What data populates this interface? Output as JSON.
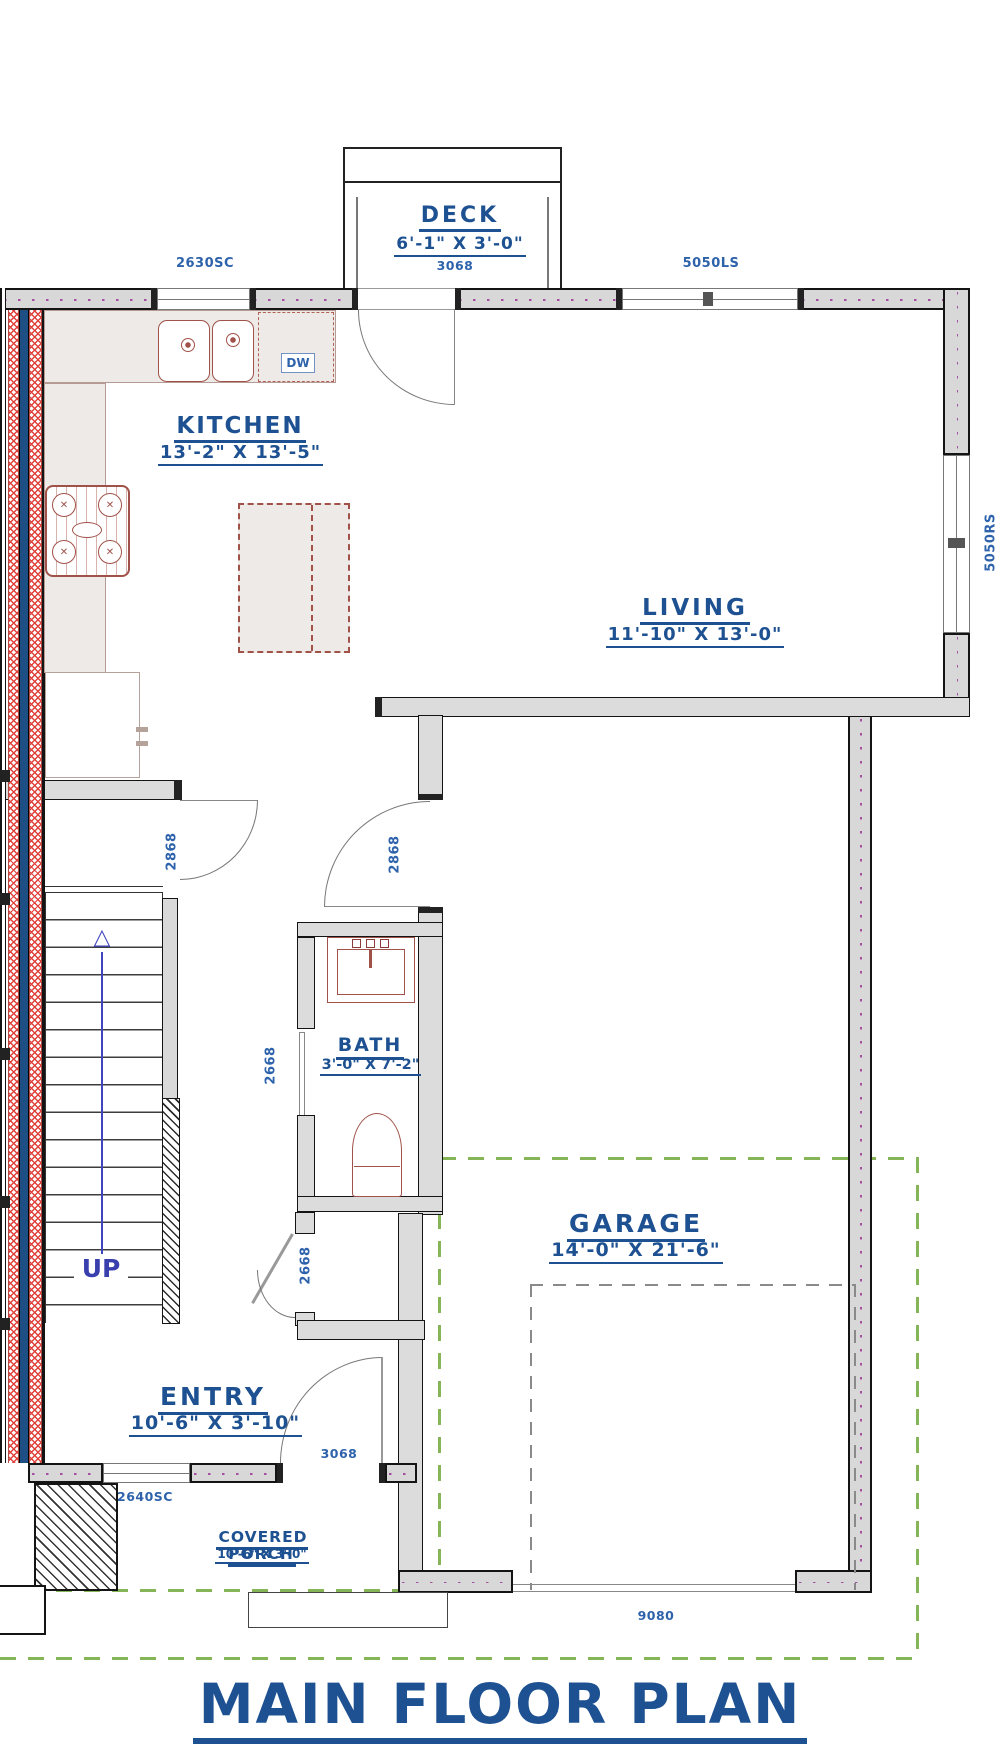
{
  "title": "MAIN FLOOR PLAN",
  "rooms": {
    "deck": {
      "name": "DECK",
      "dims": "6'-1\" X 3'-0\"",
      "door": "3068"
    },
    "kitchen": {
      "name": "KITCHEN",
      "dims": "13'-2\" X 13'-5\""
    },
    "living": {
      "name": "LIVING",
      "dims": "11'-10\" X 13'-0\""
    },
    "bath": {
      "name": "BATH",
      "dims": "3'-0\" X 7'-2\""
    },
    "garage": {
      "name": "GARAGE",
      "dims": "14'-0\" X 21'-6\"",
      "door": "9080"
    },
    "entry": {
      "name": "ENTRY",
      "dims": "10'-6\" X 3'-10\"",
      "door": "3068"
    },
    "porch": {
      "name": "COVERED PORCH",
      "dims": "10'-6\" X 3'-0\""
    }
  },
  "windows": {
    "kitchen_top": "2630SC",
    "living_top": "5050LS",
    "living_right": "5050RS",
    "entry_front": "2640SC"
  },
  "doors": {
    "hall_kitchen": "2868",
    "hall_living": "2868",
    "bath": "2668",
    "hall_closet": "2668"
  },
  "stairs": {
    "label": "UP"
  },
  "appliances": {
    "dishwasher": "DW"
  },
  "colors": {
    "label_blue": "#1d5191",
    "dim_blue": "#2e63ac",
    "wall_fill": "#d8d8d8",
    "fixture_red": "#a0524a",
    "hatch_red": "#e0413a",
    "party_wall_blue": "#1d4e84",
    "overhang_green": "#85b557",
    "stall_gray": "#8a8a8a",
    "arrow_blue": "#4044bd"
  }
}
